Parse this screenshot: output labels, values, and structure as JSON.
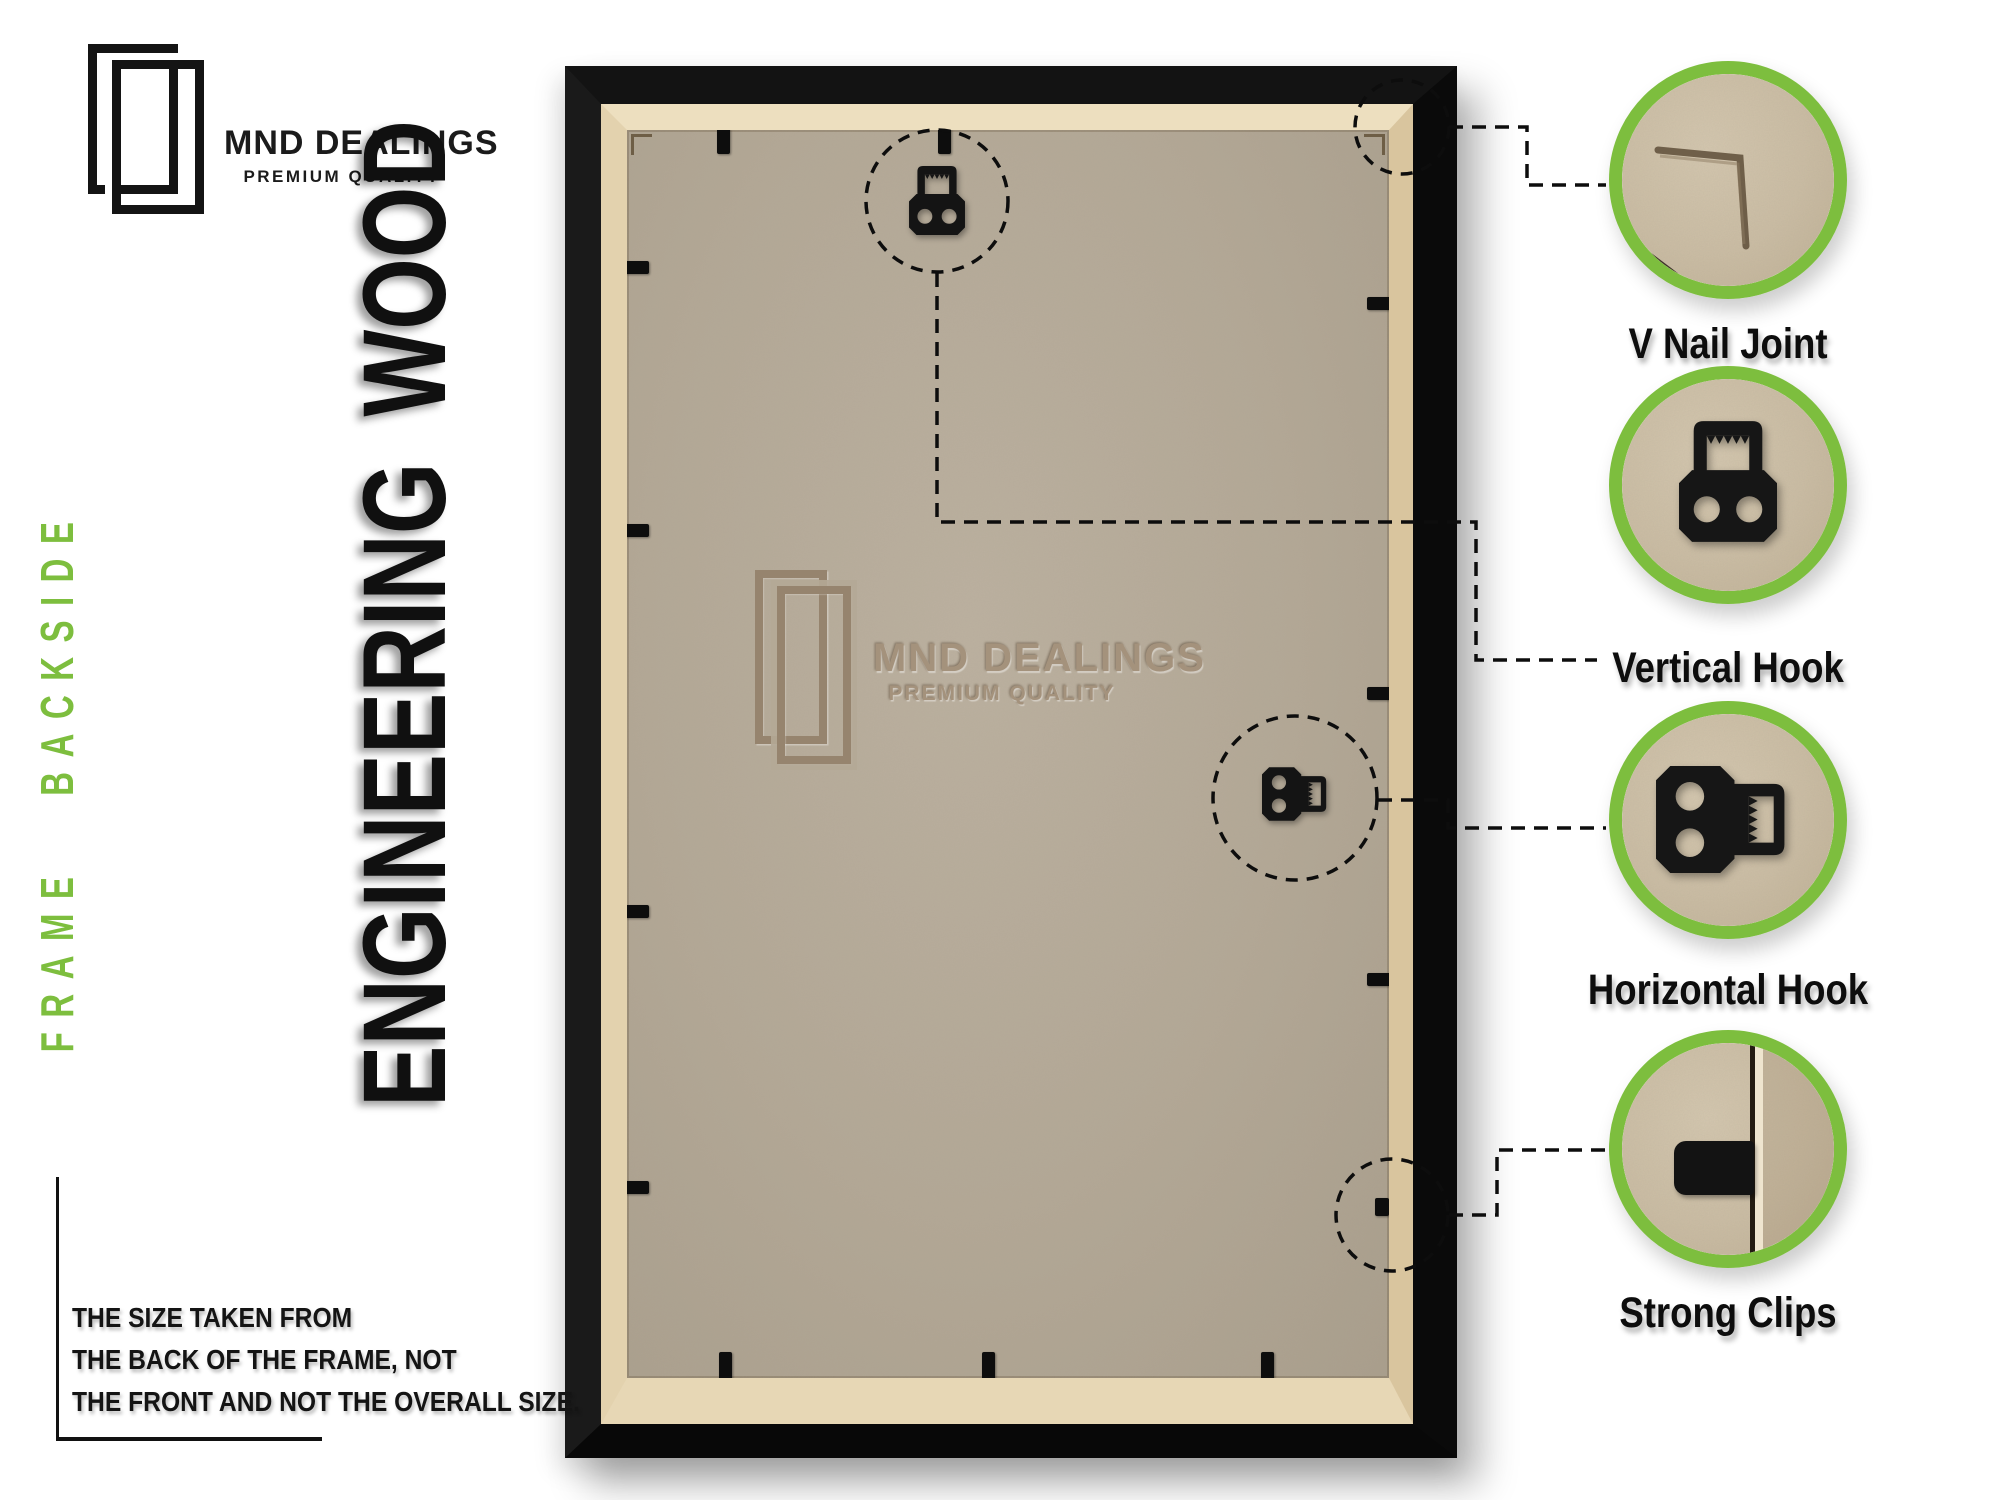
{
  "brand": {
    "name": "MND DEALINGS",
    "tagline": "PREMIUM QUALITY"
  },
  "side_label": "FRAME BACKSIDE",
  "material_label": "ENGINEERING WOOD",
  "watermark": {
    "name": "MND DEALINGS",
    "tagline": "PREMIUM QUALITY"
  },
  "note": {
    "line1": "THE SIZE TAKEN FROM",
    "line2": "THE BACK OF THE FRAME, NOT",
    "line3": "THE FRONT AND NOT THE OVERALL SIZE."
  },
  "callouts": [
    {
      "label": "V Nail Joint"
    },
    {
      "label": "Vertical Hook"
    },
    {
      "label": "Horizontal Hook"
    },
    {
      "label": "Strong Clips"
    }
  ],
  "colors": {
    "accent_green": "#7dbe3e",
    "frame_black": "#141414",
    "wood_tan": "#e3d2ae",
    "mdf_gray": "#b3a896",
    "watermark_tone": "#a3907a",
    "ink": "#141414"
  }
}
